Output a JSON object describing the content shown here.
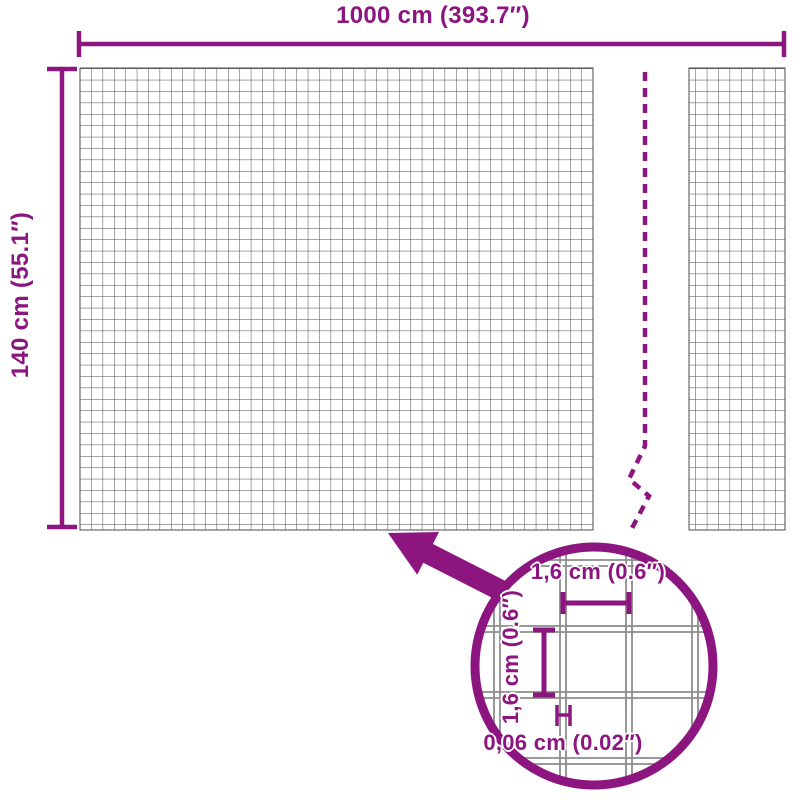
{
  "colors": {
    "accent": "#8c1580",
    "mesh_line": "#4b4b4b",
    "detail_wire": "#8c8c8c",
    "background": "#ffffff"
  },
  "diagram": {
    "width_label": "1000 cm (393.7″)",
    "height_label": "140 cm (55.1″)",
    "detail": {
      "cell_width_label": "1,6 cm (0.6″)",
      "cell_height_label": "1,6 cm (0.6″)",
      "wire_thickness_label": "0,06 cm (0.02″)"
    }
  }
}
